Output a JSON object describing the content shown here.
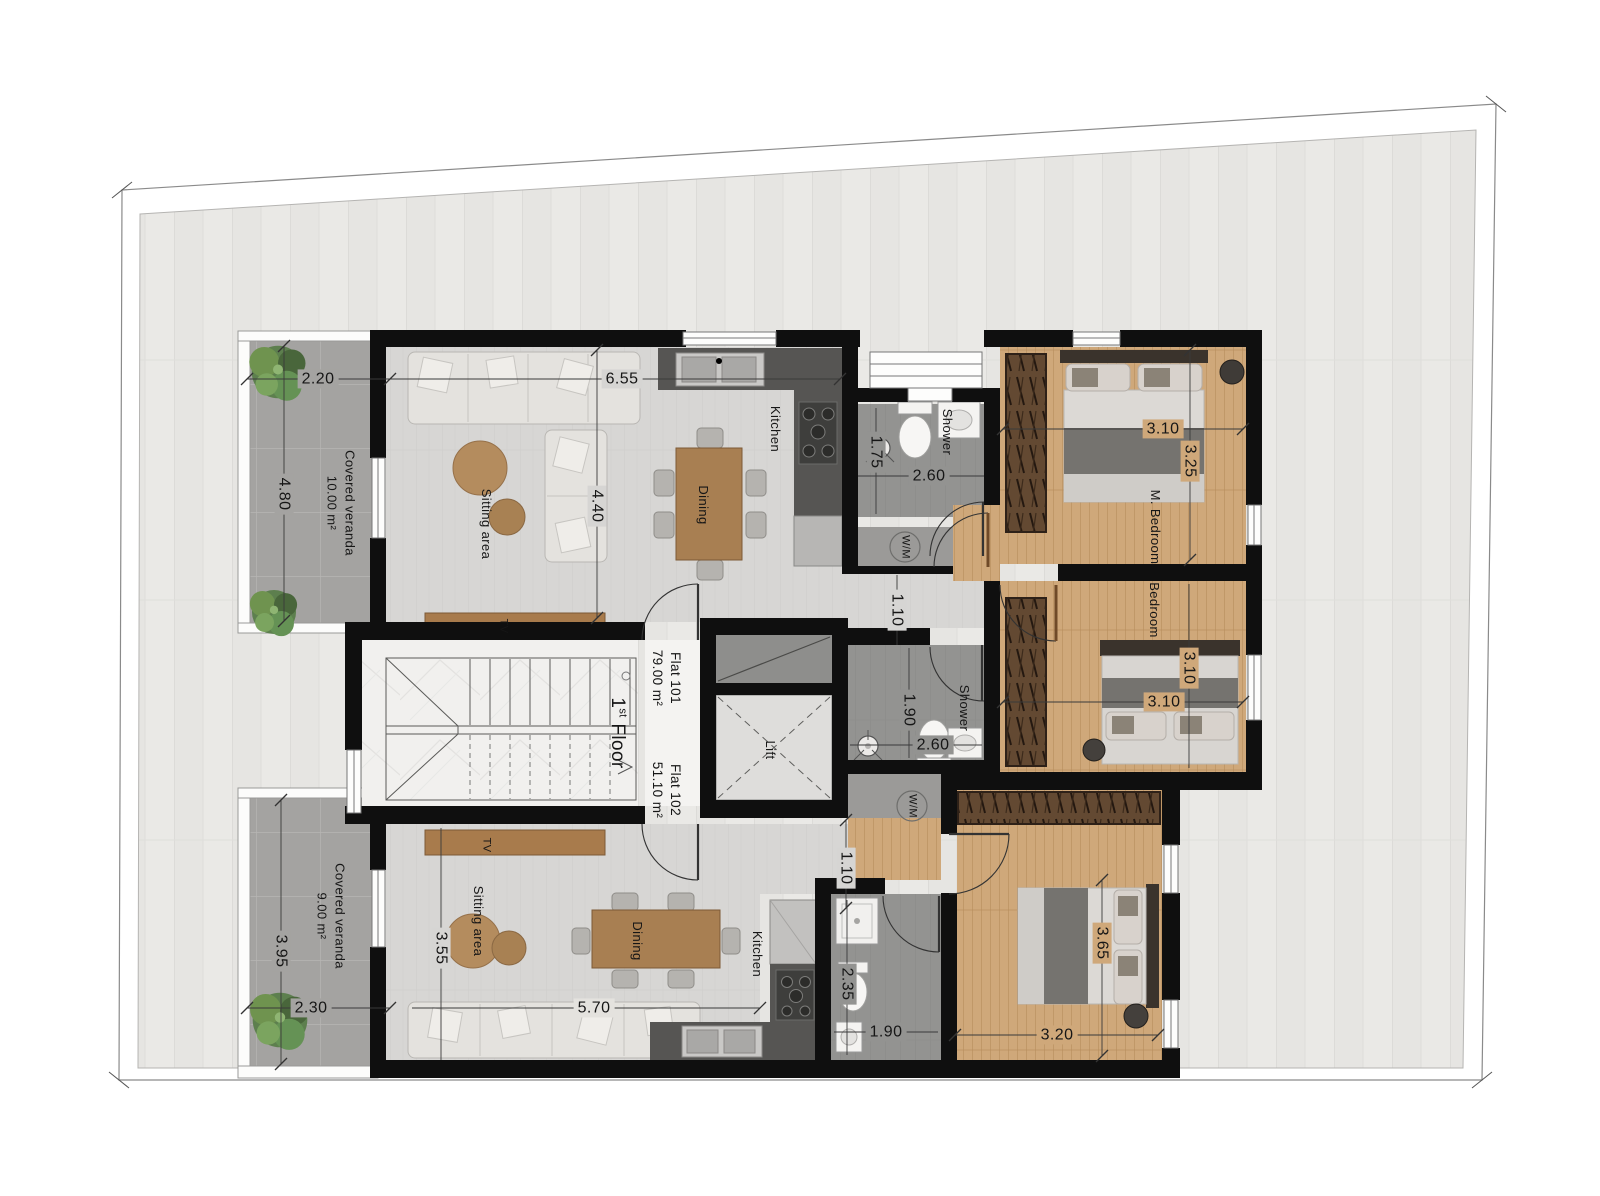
{
  "plan": {
    "floor_number": "1",
    "floor_suffix": "st",
    "floor_word": "Floor",
    "flat_101": {
      "name": "Flat 101",
      "area": "79.00 m²"
    },
    "flat_102": {
      "name": "Flat 102",
      "area": "51.10 m²"
    }
  },
  "rooms": {
    "veranda_101": {
      "label": "Covered veranda",
      "area": "10.00 m²"
    },
    "veranda_102": {
      "label": "Covered veranda",
      "area": "9.00 m²"
    },
    "sitting_101": "Sitting area",
    "sitting_102": "Sitting area",
    "kitchen_101": "Kitchen",
    "kitchen_102": "Kitchen",
    "dining_101": "Dining",
    "dining_102": "Dining",
    "shower_101": "Shower",
    "shower_102": "Shower",
    "m_bedroom": "M. Bedroom",
    "bedroom": "Bedroom",
    "lift": "Lift",
    "tv_101": "TV",
    "tv_102": "TV",
    "wm_101": "W/M",
    "wm_102": "W/M"
  },
  "dimensions": {
    "veranda101_w": "2.20",
    "living101_w": "6.55",
    "veranda101_h": "4.80",
    "sitting101_h": "4.40",
    "shower101_h": "1.75",
    "shower101_w": "2.60",
    "mbedroom_w": "3.10",
    "mbedroom_h": "3.25",
    "hall101_h": "1.10",
    "bedroom_w": "3.10",
    "bedroom_h": "3.10",
    "shower102_h": "1.90",
    "shower102_w": "2.60",
    "hall102_h": "1.10",
    "veranda102_h": "3.95",
    "veranda102_w": "2.30",
    "sitting102_h": "3.55",
    "living102_w": "5.70",
    "bath102_h": "2.35",
    "bath102_w": "1.90",
    "bedroom102_w": "3.20",
    "bedroom102_h": "3.65"
  }
}
